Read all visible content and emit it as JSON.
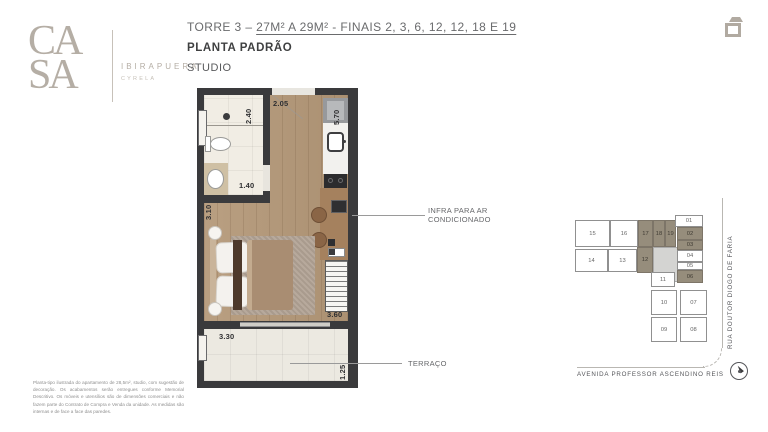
{
  "logo": {
    "letters_top": "CA",
    "letters_bottom": "SA",
    "brand": "IBIRAPUERA",
    "subbrand": "CYRELA"
  },
  "header": {
    "tower_prefix": "TORRE 3 – ",
    "tower_underlined": "27M² A 29M² - FINAIS 2, 3, 6, 12, 12, 18 E 19",
    "plan_type": "PLANTA PADRÃO",
    "unit_type": "STUDIO"
  },
  "floorplan": {
    "dims": {
      "entry_width": "2.05",
      "bath_height": "2.40",
      "kitchen_height": "5.70",
      "bath_width": "1.40",
      "room_left_height": "3.10",
      "room_width": "3.60",
      "terrace_width": "3.30",
      "terrace_depth": "1.25"
    },
    "callouts": {
      "infra_line1": "INFRA PARA AR",
      "infra_line2": "CONDICIONADO",
      "terrace": "TERRAÇO"
    }
  },
  "keyplan": {
    "units": [
      {
        "label": "15",
        "highlighted": false
      },
      {
        "label": "16",
        "highlighted": false
      },
      {
        "label": "17",
        "highlighted": true
      },
      {
        "label": "18",
        "highlighted": true
      },
      {
        "label": "19",
        "highlighted": true
      },
      {
        "label": "14",
        "highlighted": false
      },
      {
        "label": "13",
        "highlighted": false
      },
      {
        "label": "12",
        "highlighted": true
      },
      {
        "label": "01",
        "highlighted": false
      },
      {
        "label": "02",
        "highlighted": true
      },
      {
        "label": "03",
        "highlighted": true
      },
      {
        "label": "04",
        "highlighted": false
      },
      {
        "label": "05",
        "highlighted": false
      },
      {
        "label": "06",
        "highlighted": true
      },
      {
        "label": "11",
        "highlighted": false
      },
      {
        "label": "10",
        "highlighted": false
      },
      {
        "label": "07",
        "highlighted": false
      },
      {
        "label": "09",
        "highlighted": false
      },
      {
        "label": "08",
        "highlighted": false
      }
    ],
    "streets": {
      "right": "RUA DOUTOR DIOGO DE FARIA",
      "bottom": "AVENIDA PROFESSOR ASCENDINO REIS"
    }
  },
  "disclaimer": "Planta-tipo ilustrada do apartamento de 28,5m², studio, com sugestão de decoração. Os acabamentos serão entregues conforme Memorial Descritivo. Os móveis e utensílios são de dimensões comerciais e não fazem parte do Contrato de Compra e Venda da unidade. As medidas são internas e de face a face das paredes.",
  "colors": {
    "wall": "#3a3a3c",
    "wood": "#b49878",
    "highlight": "#968d7c",
    "logo": "#b5aea5"
  }
}
